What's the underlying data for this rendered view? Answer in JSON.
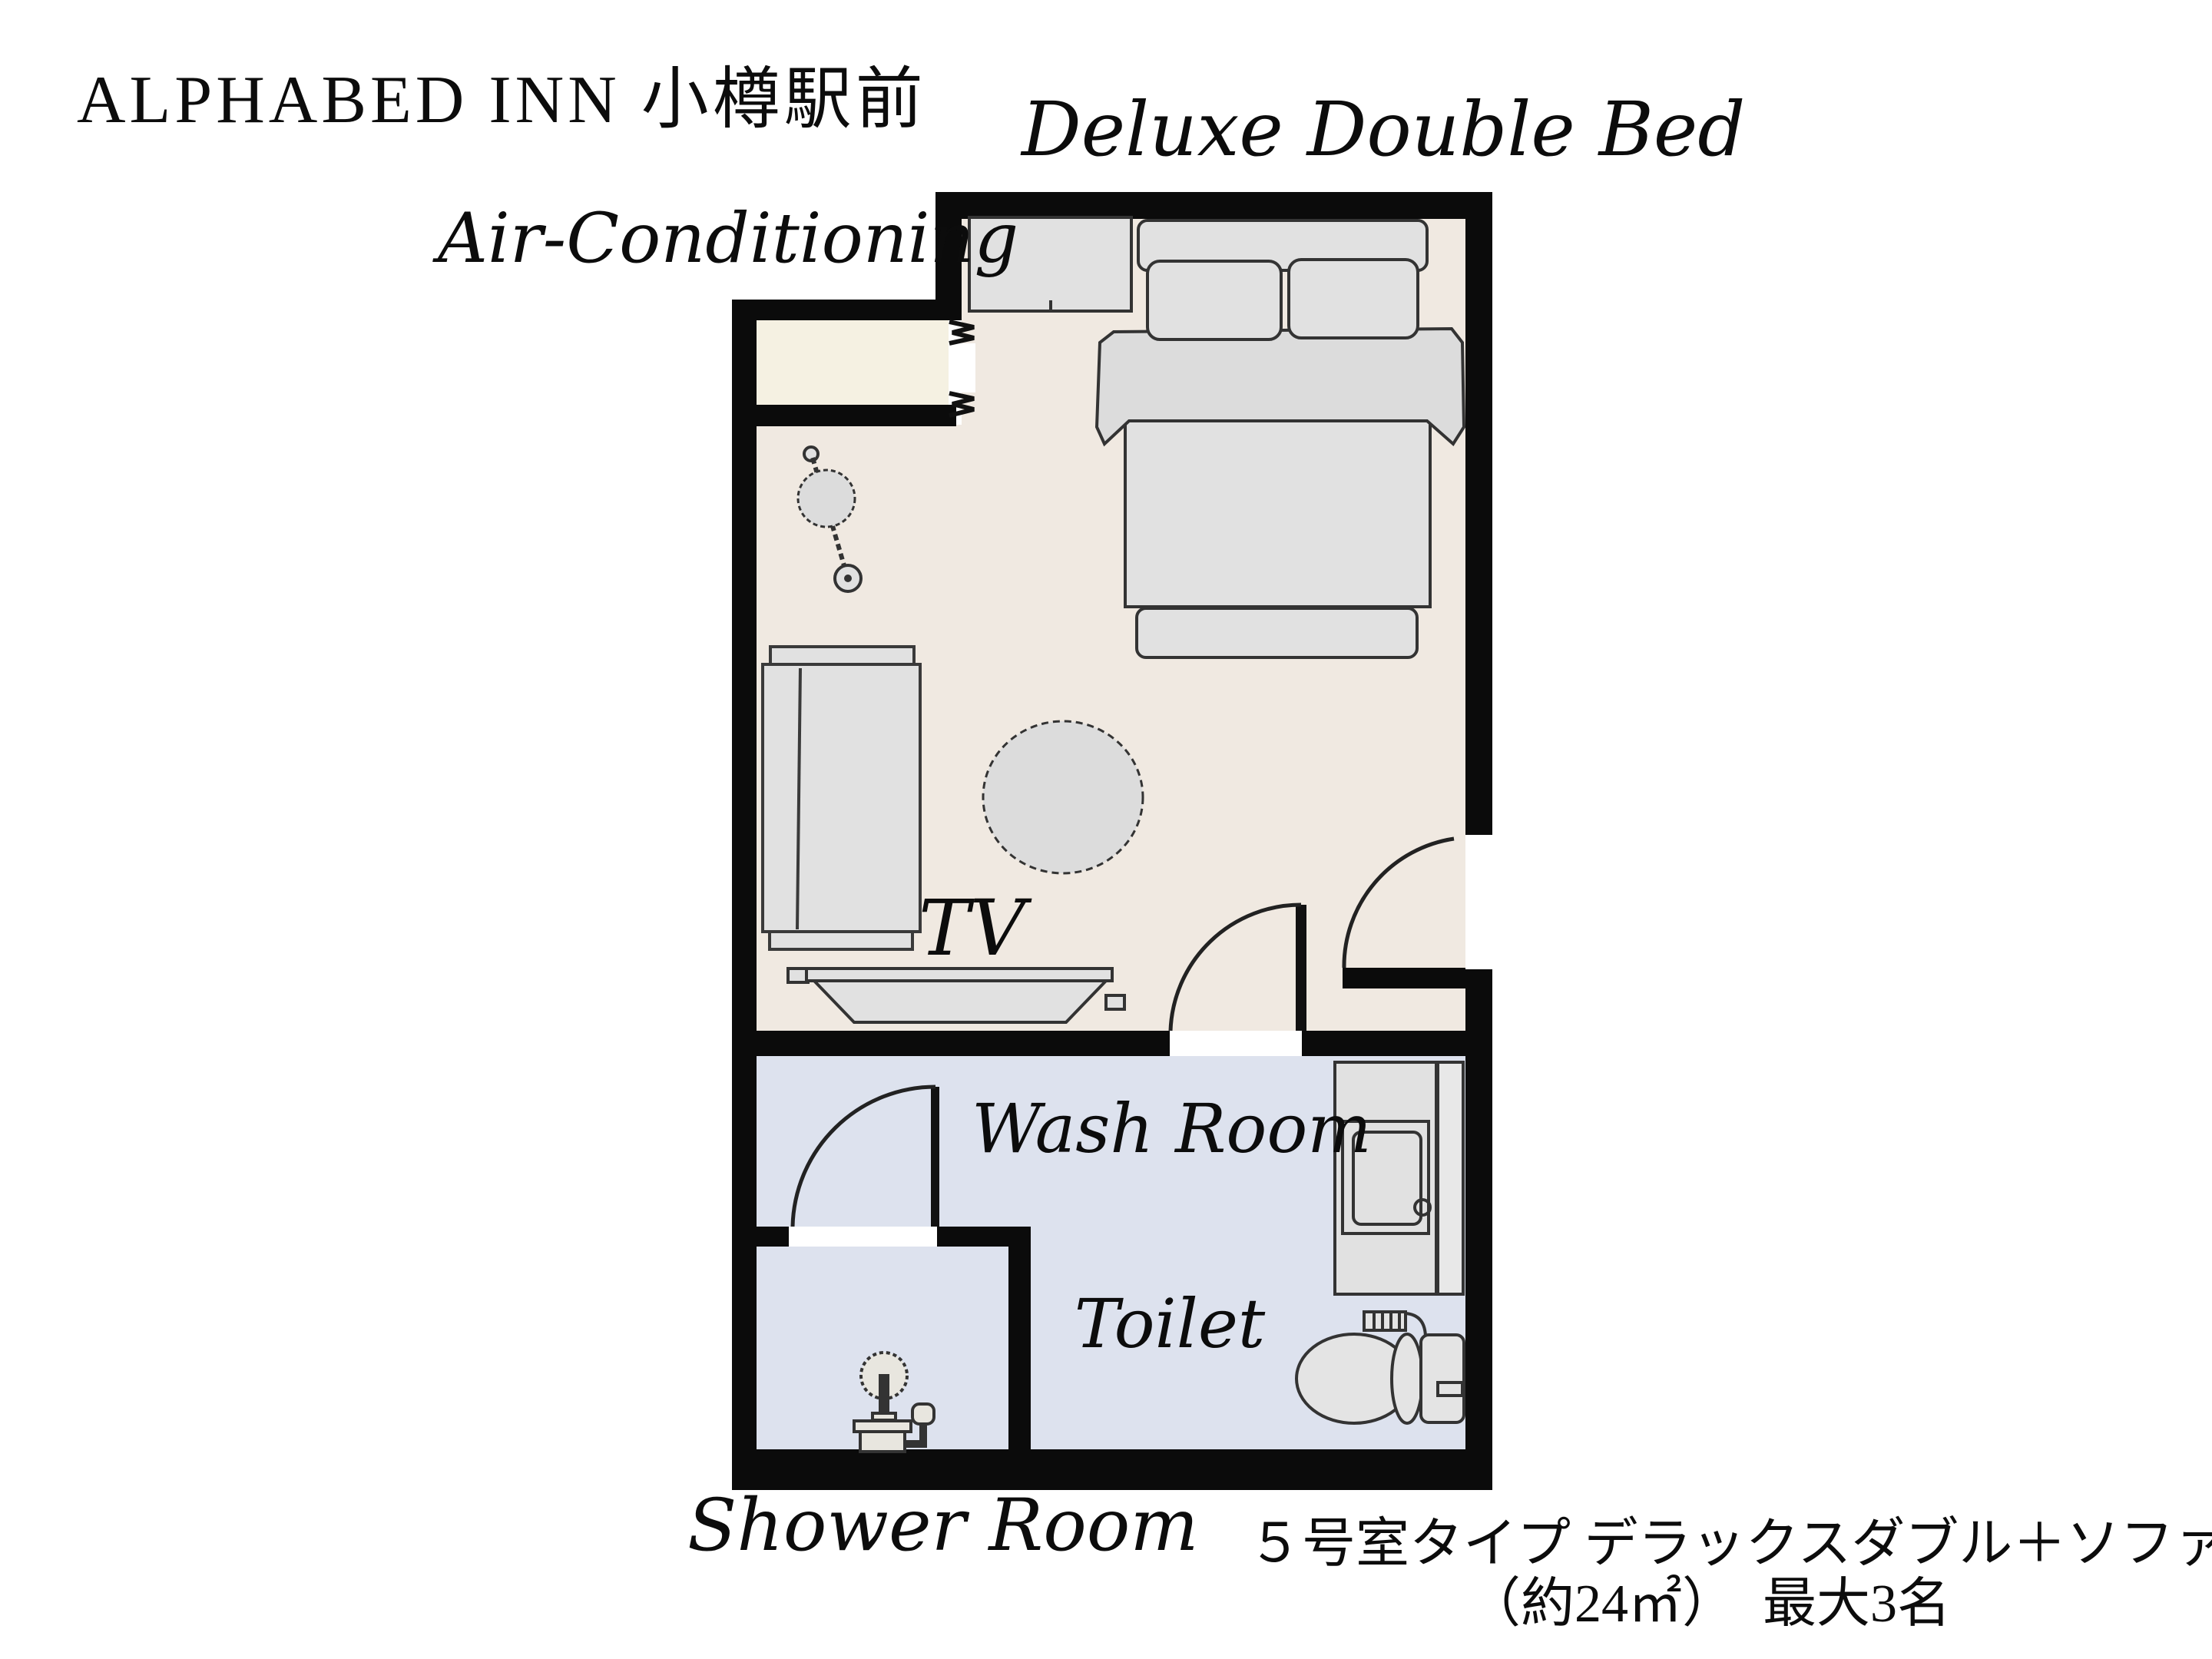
{
  "header": {
    "title": "ALPHABED INN 小樽駅前"
  },
  "plan_labels": {
    "bed_type": "Deluxe Double Bed",
    "air_conditioning": "Air-Conditioning",
    "tv": "TV",
    "wash_room": "Wash Room",
    "toilet": "Toilet",
    "shower_room": "Shower Room"
  },
  "caption": {
    "line1": "５号室タイプ デラックスダブル＋ソファーベッド",
    "line2": "（約24㎡）　最大3名"
  },
  "colors": {
    "wall": "#0b0b0b",
    "bedroom_floor": "#f0e9e1",
    "entry_floor": "#f5f1e2",
    "bathroom_floor": "#dde2ee",
    "furniture_fill": "#e1e1e1",
    "furniture_stroke": "#333333"
  },
  "furniture": [
    "wardrobe",
    "double-bed",
    "pillows",
    "floor-lamp",
    "sofa",
    "round-rug",
    "tv-stand",
    "washing-machine",
    "toilet",
    "shower-stand",
    "entry-door",
    "washroom-door",
    "shower-door"
  ]
}
